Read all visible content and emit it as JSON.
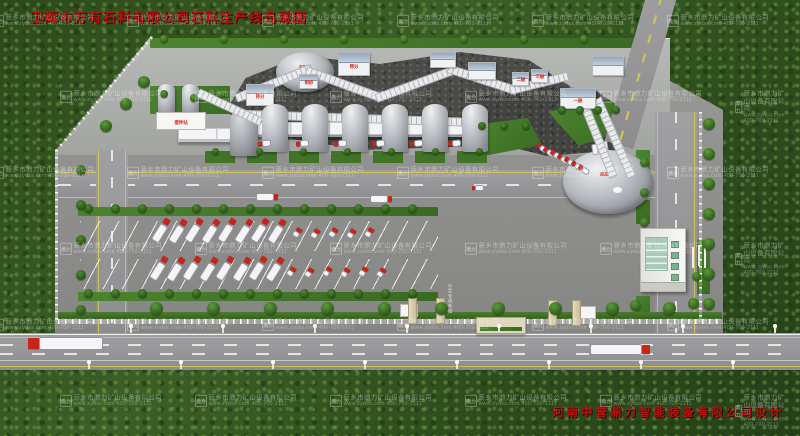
{
  "title": "卫辉市万有石料有限公司石料生产线鸟瞰图",
  "credit": "河南中誉鼎力智能装备有限公司设计",
  "watermark": {
    "logo": "鼎力",
    "company": "新乡市鼎力矿山设备有限公司",
    "contact": "www.zydss.com  400-700-2111"
  },
  "labels": {
    "screen_a": "筛分",
    "screen_b": "筛分",
    "sand": "制砂",
    "primary": "一破",
    "secondary": "二破",
    "tertiary": "三破",
    "batching": "搅拌站",
    "dome_top": "石料棚",
    "dome_finished": "成品料仓",
    "road_lane": "空车专用车道"
  },
  "colors": {
    "title_red": "#b81110",
    "sign_red": "#d5281a",
    "lawn_green": "#3f7423",
    "road_gray": "#98989a",
    "forest_green": "#2e4d1e"
  }
}
